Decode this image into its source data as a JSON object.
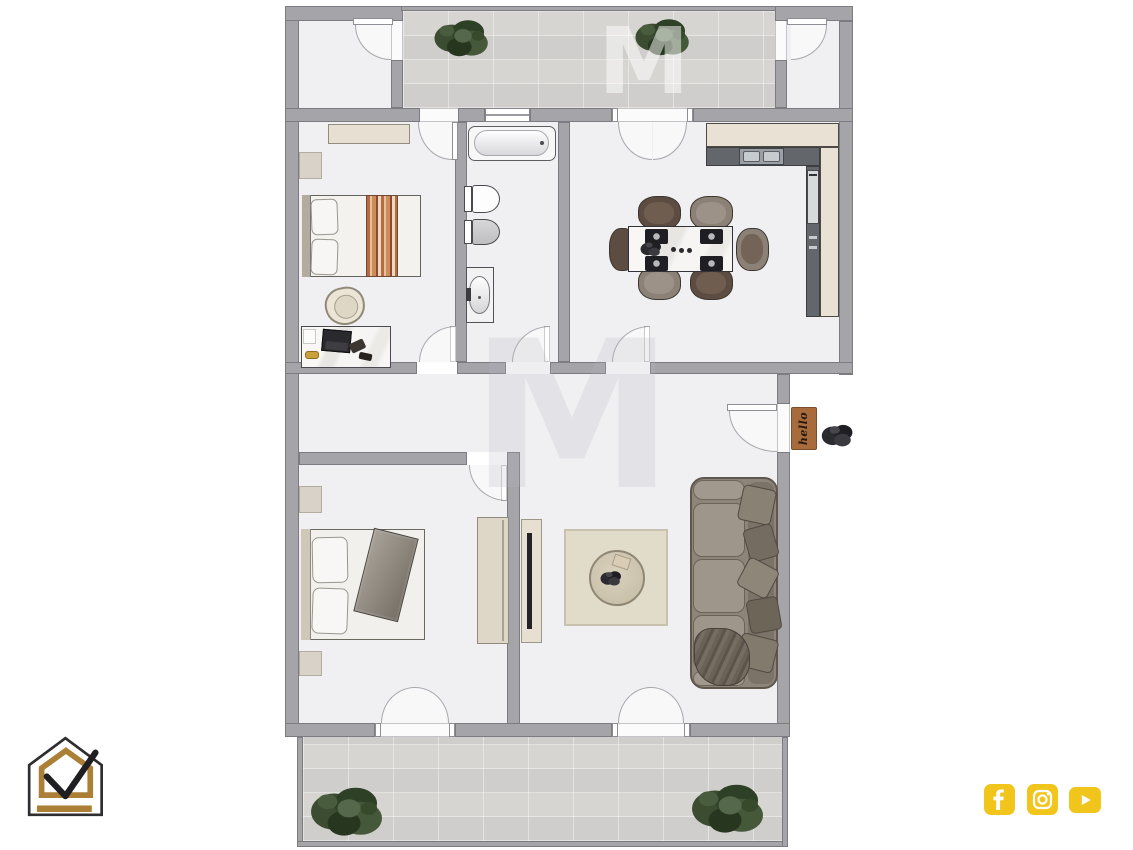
{
  "canvas": {
    "width": 1133,
    "height": 850,
    "background": "#ffffff"
  },
  "plan": {
    "type": "apartment-floor-plan-top-view",
    "palette": {
      "wall": "#a4a4a9",
      "wall_outline": "#7b7b81",
      "floor": "#f0f0f2",
      "balcony_tile": "#d6d5d2",
      "wood_beige": "#e7e0d2",
      "counter_dark": "#63666b",
      "sofa": "#8d847a",
      "rug": "#e1dbca",
      "plant_green": "#3b4c31"
    },
    "rooms": [
      "storage-top-left",
      "balcony-top",
      "storage-top-right",
      "bedroom-1",
      "bathroom",
      "kitchen-dining",
      "hallway",
      "bedroom-2",
      "living-room",
      "balcony-bottom"
    ],
    "furniture": [
      "shelf",
      "single-bed",
      "desk-with-laptop",
      "armchair",
      "bathtub",
      "toilet",
      "bidet",
      "washbasin",
      "kitchen-counter",
      "kitchen-sink",
      "oven",
      "dining-table",
      "dining-chairs",
      "double-bed",
      "wardrobe",
      "tv-console",
      "tv",
      "rug",
      "coffee-table",
      "sofa",
      "doormat",
      "potted-plants"
    ]
  },
  "entrance": {
    "mat_text": "hello",
    "mat_color": "#a86b3c"
  },
  "watermark": {
    "letter": "M"
  },
  "logo": {
    "outline_color": "#2e2e31",
    "accent_color": "#ab8036",
    "check_color": "#1f1f23"
  },
  "social": {
    "accent_color": "#f2c51d",
    "icons": [
      {
        "name": "facebook"
      },
      {
        "name": "instagram"
      },
      {
        "name": "youtube"
      }
    ]
  }
}
